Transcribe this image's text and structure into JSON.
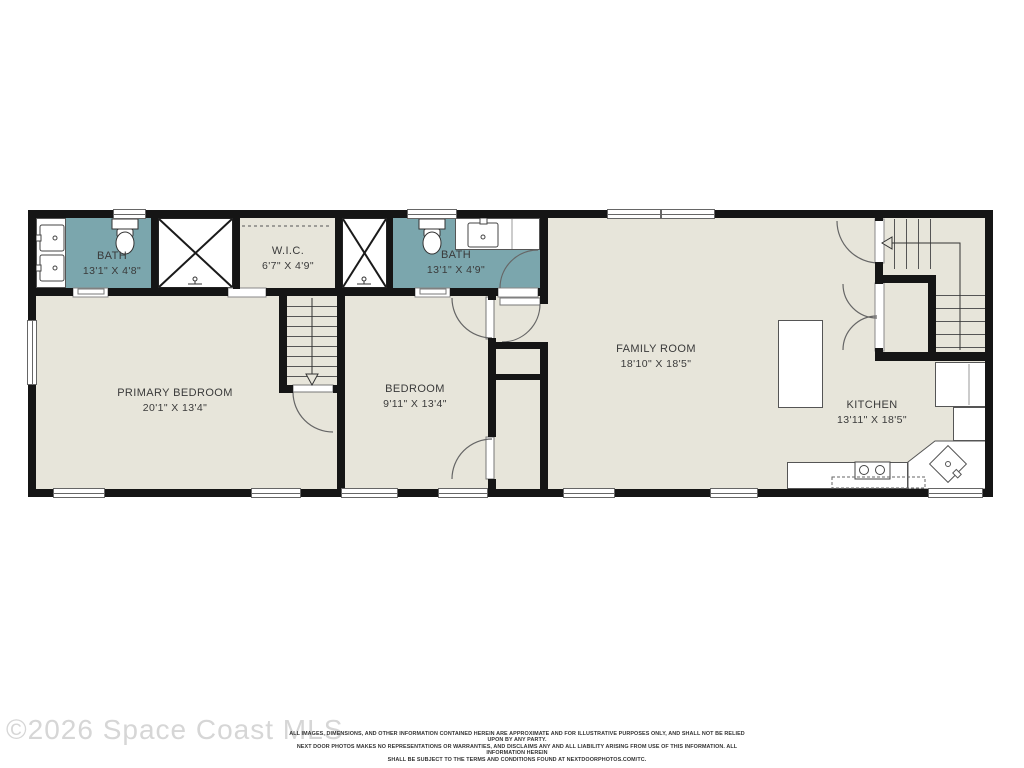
{
  "watermark": "©2026 Space Coast MLS",
  "colors": {
    "bath_fill": "#7BA6AD",
    "floor": "#E7E5DA",
    "wall": "#151515"
  },
  "rooms": {
    "bath1": {
      "name": "BATH",
      "dims": "13'1\" X 4'8\""
    },
    "wic": {
      "name": "W.I.C.",
      "dims": "6'7\" X 4'9\""
    },
    "bath2": {
      "name": "BATH",
      "dims": "13'1\" X 4'9\""
    },
    "primary_bedroom": {
      "name": "PRIMARY BEDROOM",
      "dims": "20'1\" X 13'4\""
    },
    "bedroom": {
      "name": "BEDROOM",
      "dims": "9'11\" X 13'4\""
    },
    "family_room": {
      "name": "FAMILY ROOM",
      "dims": "18'10\" X 18'5\""
    },
    "kitchen": {
      "name": "KITCHEN",
      "dims": "13'11\" X 18'5\""
    }
  },
  "disclaimer": {
    "line1": "ALL IMAGES, DIMENSIONS, AND OTHER INFORMATION CONTAINED HEREIN ARE APPROXIMATE AND FOR ILLUSTRATIVE PURPOSES ONLY, AND SHALL NOT BE RELIED UPON BY ANY PARTY.",
    "line2": "NEXT DOOR PHOTOS MAKES NO REPRESENTATIONS OR WARRANTIES, AND DISCLAIMS ANY AND ALL LIABILITY ARISING FROM USE OF THIS INFORMATION. ALL INFORMATION HEREIN",
    "line3": "SHALL BE SUBJECT TO THE TERMS AND CONDITIONS FOUND AT NEXTDOORPHOTOS.COM/TC."
  }
}
